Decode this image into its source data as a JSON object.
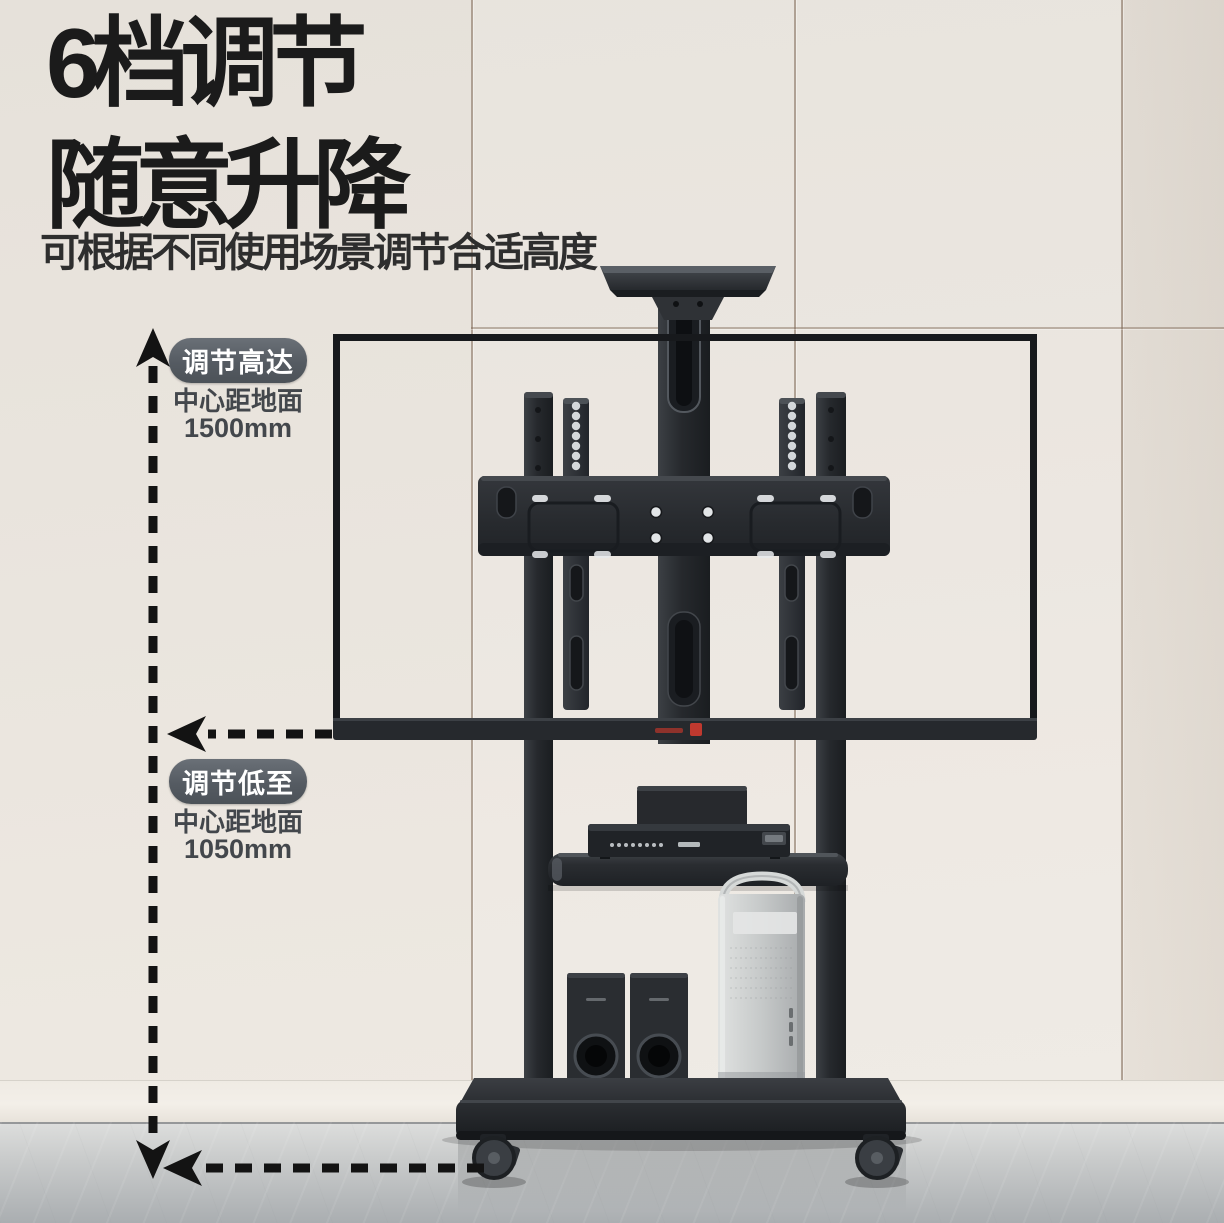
{
  "canvas": {
    "width": 1224,
    "height": 1223
  },
  "header": {
    "title_line1": "6档调节",
    "title_line2": "随意升降",
    "subtitle": "可根据不同使用场景调节合适高度"
  },
  "annotations": {
    "upper": {
      "badge": "调节高达",
      "caption": "中心距地面",
      "value": "1500mm"
    },
    "lower": {
      "badge": "调节低至",
      "caption": "中心距地面",
      "value": "1050mm"
    }
  },
  "product": {
    "items": [
      "camera-tray",
      "tv-outline",
      "vesa-mount",
      "stand-columns",
      "media-shelf",
      "media-player",
      "soundbar",
      "pc-tower",
      "speakers",
      "base-platform",
      "caster-wheels"
    ]
  },
  "colors": {
    "title_text": "#1b1b1b",
    "subtitle_text": "#2e2e2e",
    "badge_bg": "#555b62",
    "badge_text": "#ffffff",
    "caption_text": "#43474c",
    "dash_line": "#131313",
    "wall": "#e9e4dd",
    "wall_seam": "#8a7460",
    "baseboard": "#f2eee7",
    "floor_light": "#dcdddc",
    "floor_dark": "#a9adb0",
    "stand_black": "#26292d",
    "tower_silver": "#c9cccc",
    "logo_red": "#c0392f"
  }
}
